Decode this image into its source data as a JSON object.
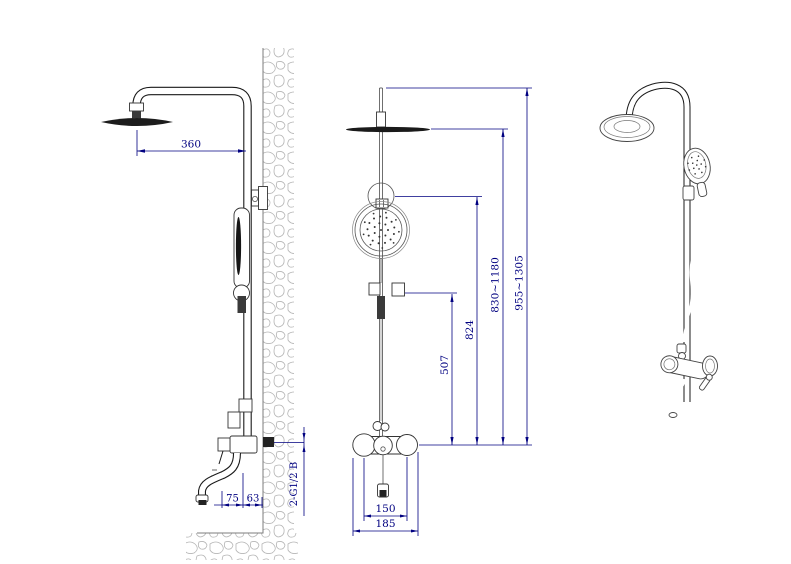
{
  "colors": {
    "line": "#1a1a1a",
    "dimension": "#000080",
    "hatch": "#b5b5b5",
    "background": "#ffffff"
  },
  "dimensions": {
    "arm_reach": "360",
    "spout_projection": "75",
    "spout_wall_offset": "63",
    "inlet_thread": "2-G1/2 B",
    "slider_bracket_height": "507",
    "holder_height": "824",
    "rain_head_height_range": "830~1180",
    "overall_height_range": "955~1305",
    "inlet_center_spacing": "150",
    "valve_body_width": "185"
  }
}
